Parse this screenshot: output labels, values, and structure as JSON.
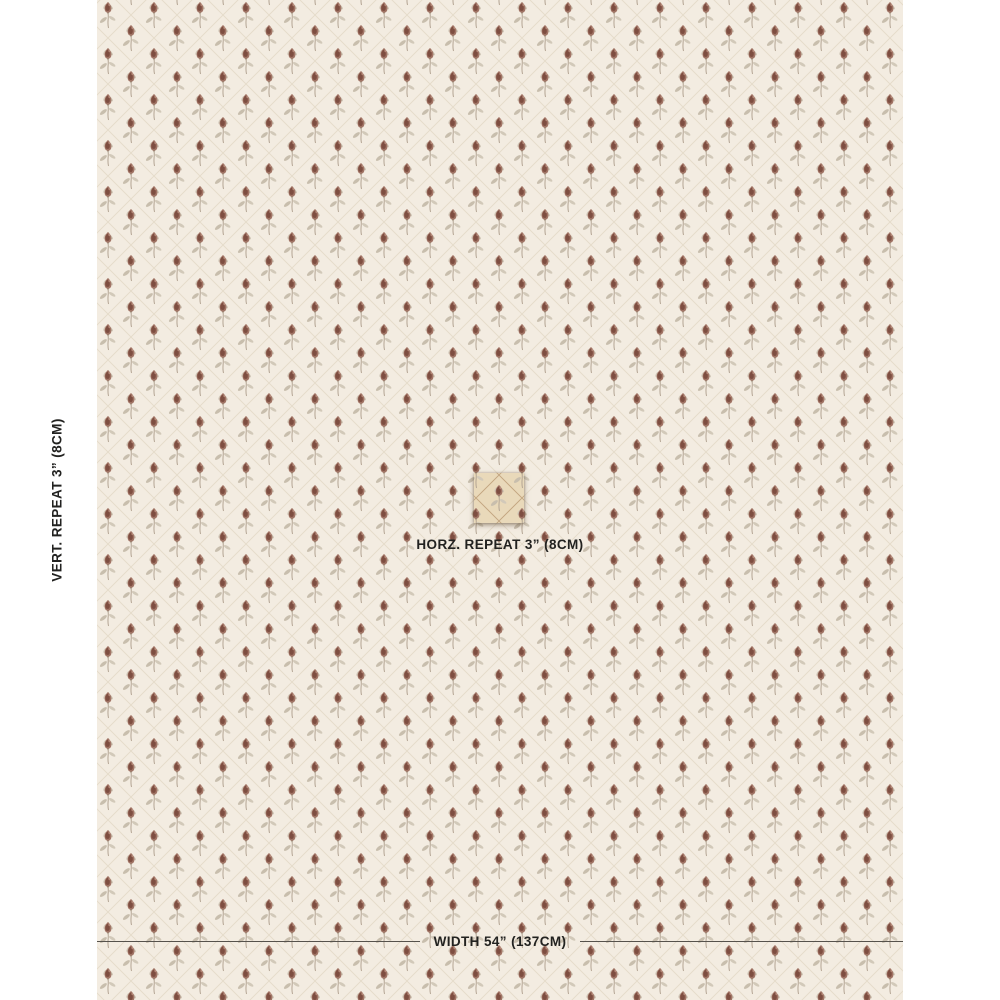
{
  "labels": {
    "vertical_repeat": "VERT. REPEAT 3” (8CM)",
    "horizontal_repeat": "HORZ. REPEAT 3” (8CM)",
    "width": "WIDTH 54” (137CM)"
  },
  "swatch": {
    "description": "cream fabric with diamond trellis lattice and small flower-bud sprigs, one repeat tile highlighted at center",
    "colors": {
      "page_bg": "#ffffff",
      "fabric_bg": "#f3ece1",
      "lattice_line": "#e5dbc9",
      "bud": "#a17465",
      "bud_dark": "#7e4e41",
      "bud_highlight": "#c49a87",
      "calyx": "#9c8d7a",
      "leaf": "#c8bead",
      "leaf_light": "#d2c9b9",
      "stem": "#b3a493",
      "tile_bg": "#e9d9ba",
      "tile_lattice": "#c2a57f",
      "rule_line": "#56524c",
      "text": "#222220"
    }
  }
}
